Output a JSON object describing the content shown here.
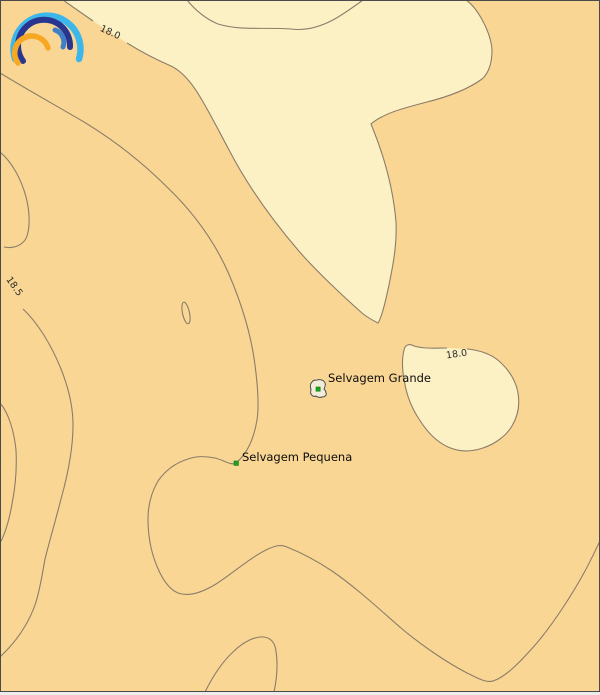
{
  "map": {
    "type": "sea-surface-temperature contour map",
    "contour_labels": {
      "top": "18.0",
      "left": "18.5",
      "right_blob": "18.0"
    },
    "places": {
      "grande": "Selvagem Grande",
      "pequena": "Selvagem Pequena"
    },
    "colors": {
      "sea_warm": "#FAD694",
      "sea_cool": "#FCF0C5",
      "contour_line": "#8B7D68",
      "label_text": "#2B2B2B",
      "marker_green": "#1FA21F",
      "island_fill": "#F2EDD8",
      "frame": "#4A4A4A"
    },
    "logo": {
      "icon": "rainbow-arcs-logo",
      "arc_outer_color": "#3DB7EA",
      "arc_middle_color": "#28368F",
      "arc_inner_right_color": "#3E7FC6",
      "arc_inner_left_color": "#F7A823"
    }
  }
}
